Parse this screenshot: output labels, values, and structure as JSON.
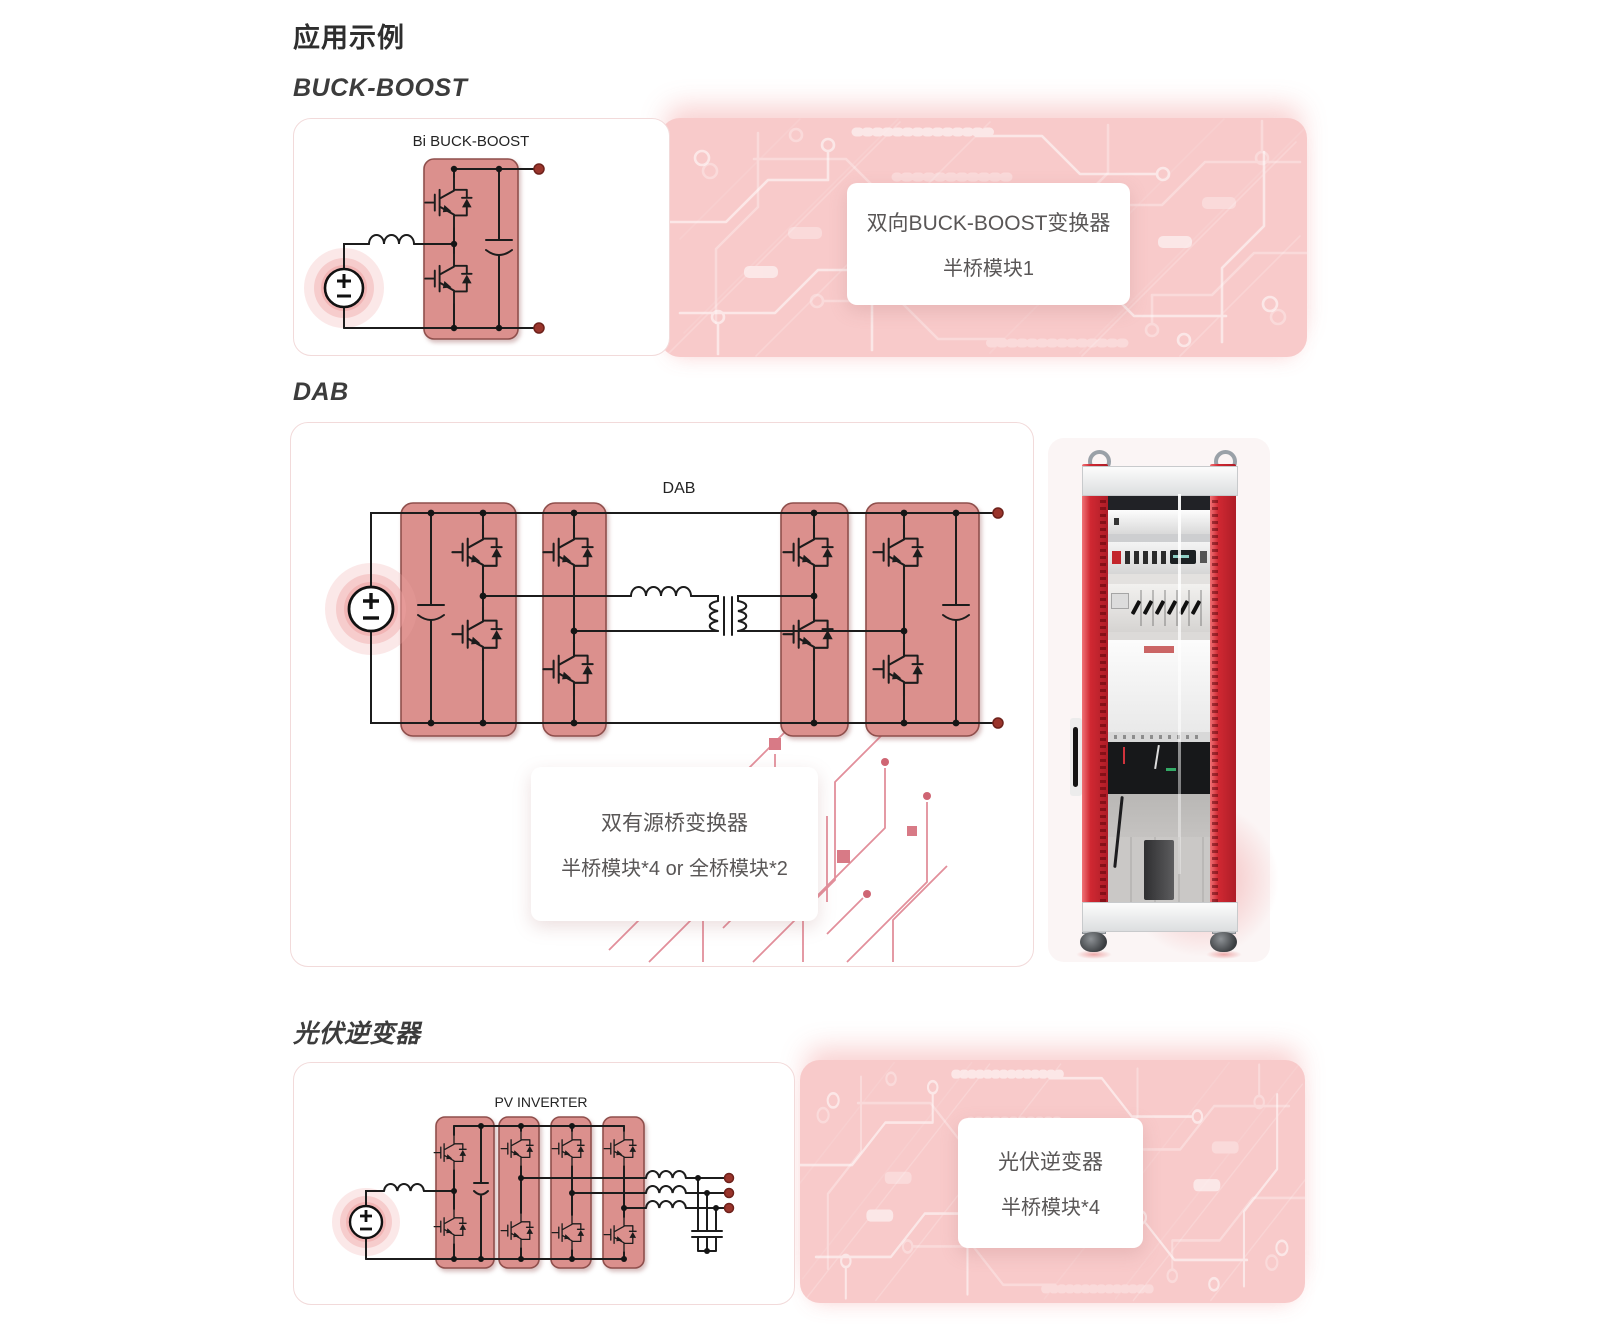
{
  "page": {
    "title": "应用示例"
  },
  "colors": {
    "accent_red": "#b30d28",
    "strip_pink": "#f8caca",
    "module_fill": "#db908d",
    "module_border": "#8f4f4c",
    "terminal_red": "#9a352c",
    "rack_red": "#cc2530",
    "callout_text": "#595656"
  },
  "sections": {
    "buck": {
      "heading": "BUCK-BOOST",
      "circuit_label": "Bi BUCK-BOOST",
      "callout": {
        "line1": "双向BUCK-BOOST变换器",
        "line2": "半桥模块1"
      }
    },
    "dab": {
      "heading": "DAB",
      "circuit_label": "DAB",
      "callout": {
        "line1": "双有源桥变换器",
        "line2": "半桥模块*4 or  全桥模块*2"
      }
    },
    "pv": {
      "heading": "光伏逆变器",
      "circuit_label": "PV INVERTER",
      "callout": {
        "line1": "光伏逆变器",
        "line2": "半桥模块*4"
      }
    }
  }
}
